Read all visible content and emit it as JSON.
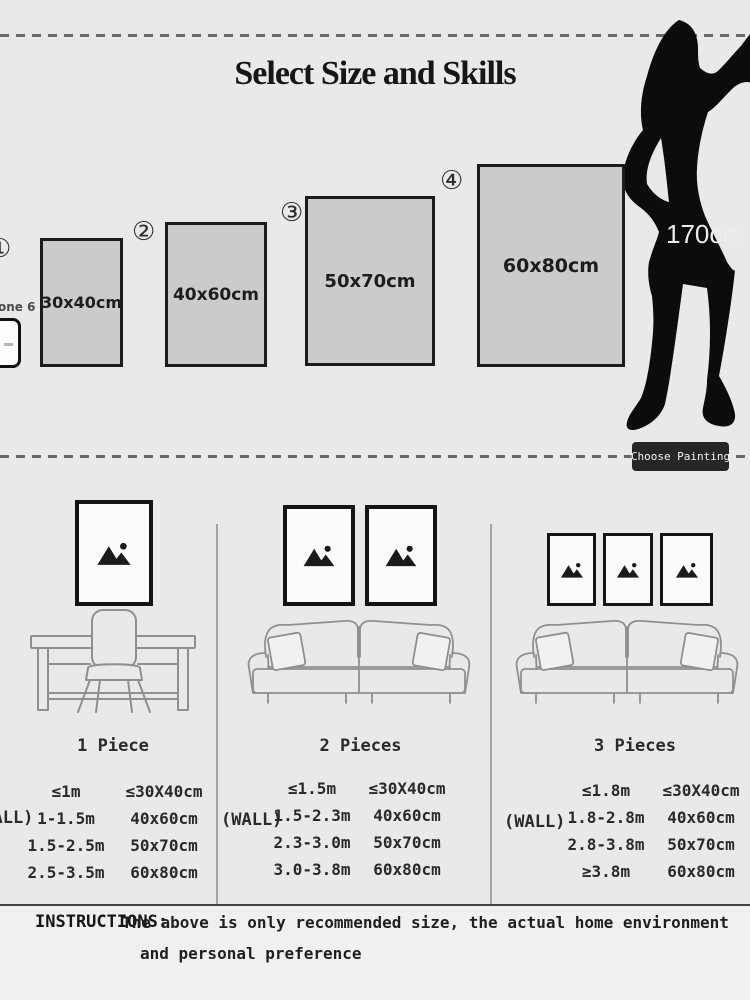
{
  "colors": {
    "background": "#e9e9e9",
    "swatch_fill": "#cbcbcb",
    "ink": "#1a1a1a",
    "line_art": "#8f8f8f",
    "button_bg": "#262626",
    "button_text": "#f4f4f4",
    "silhouette": "#0c0c0c"
  },
  "size_selector": {
    "title": "Select Size and Skills",
    "reference_height": "170cm",
    "phone_caption": "one 6",
    "choose_button": "Choose Painting",
    "options": [
      {
        "number": "①",
        "size": "30x40cm"
      },
      {
        "number": "②",
        "size": "40x60cm"
      },
      {
        "number": "③",
        "size": "50x70cm"
      },
      {
        "number": "④",
        "size": "60x80cm"
      }
    ]
  },
  "arrangements": [
    {
      "label": "1 Piece",
      "wall": "(WALL)",
      "rows": [
        {
          "wall_width": "≤1m",
          "size": "≤30X40cm"
        },
        {
          "wall_width": "1-1.5m",
          "size": "40x60cm"
        },
        {
          "wall_width": "1.5-2.5m",
          "size": "50x70cm"
        },
        {
          "wall_width": "2.5-3.5m",
          "size": "60x80cm"
        }
      ]
    },
    {
      "label": "2 Pieces",
      "wall": "(WALL)",
      "rows": [
        {
          "wall_width": "≤1.5m",
          "size": "≤30X40cm"
        },
        {
          "wall_width": "1.5-2.3m",
          "size": "40x60cm"
        },
        {
          "wall_width": "2.3-3.0m",
          "size": "50x70cm"
        },
        {
          "wall_width": "3.0-3.8m",
          "size": "60x80cm"
        }
      ]
    },
    {
      "label": "3 Pieces",
      "wall": "(WALL)",
      "rows": [
        {
          "wall_width": "≤1.8m",
          "size": "≤30X40cm"
        },
        {
          "wall_width": "1.8-2.8m",
          "size": "40x60cm"
        },
        {
          "wall_width": "2.8-3.8m",
          "size": "50x70cm"
        },
        {
          "wall_width": "≥3.8m",
          "size": "60x80cm"
        }
      ]
    }
  ],
  "instructions": {
    "label": "INSTRUCTIONS:",
    "line1": "The above is only recommended size, the actual home environment",
    "line2": "and personal preference"
  }
}
